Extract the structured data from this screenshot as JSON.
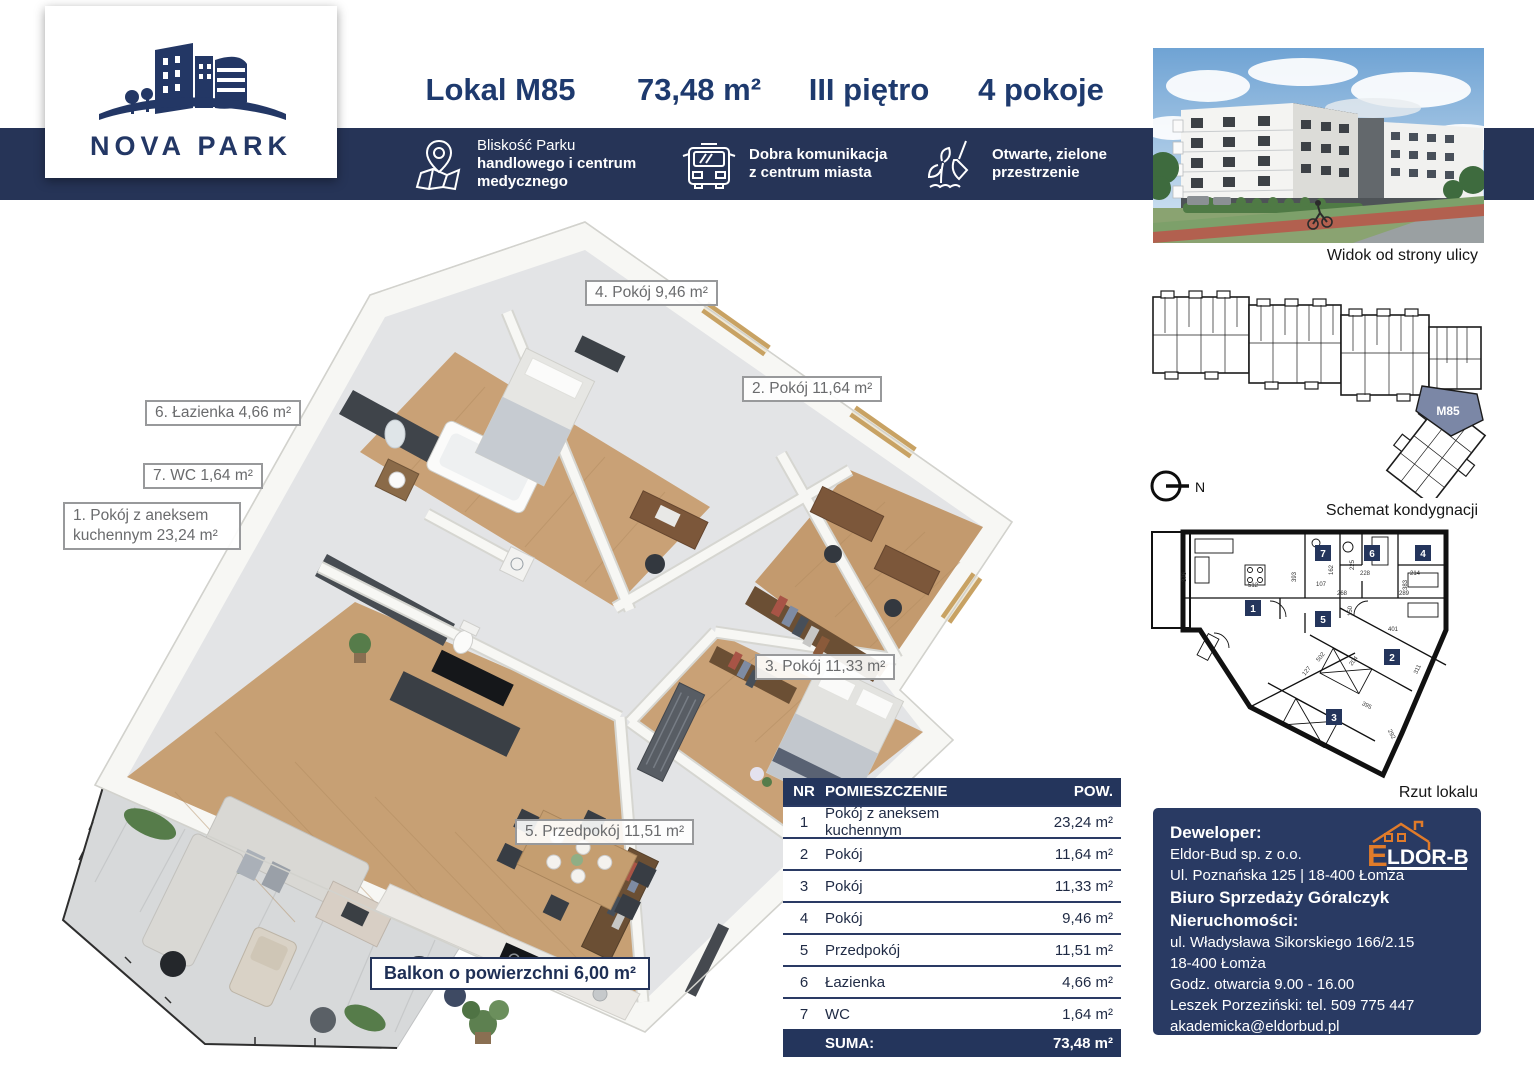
{
  "brand": {
    "name": "NOVA PARK"
  },
  "header": {
    "unit": "Lokal M85",
    "area": "73,48 m²",
    "floor": "III piętro",
    "rooms": "4 pokoje",
    "features": [
      {
        "icon": "map-pin-icon",
        "lines": [
          "Bliskość Parku",
          "handlowego i centrum",
          "medycznego"
        ]
      },
      {
        "icon": "bus-icon",
        "lines": [
          "Dobra komunikacja",
          "z centrum miasta"
        ]
      },
      {
        "icon": "plant-trowel-icon",
        "lines": [
          "Otwarte, zielone",
          "przestrzenie"
        ]
      }
    ]
  },
  "sidebar": {
    "photo_caption": "Widok od strony ulicy",
    "schematic_caption": "Schemat kondygnacji",
    "unit_plan_caption": "Rzut lokalu",
    "unit_label": "M85",
    "north_label": "N"
  },
  "floorplan": {
    "labels": {
      "r4": "4. Pokój 9,46 m²",
      "r2": "2. Pokój 11,64 m²",
      "r6": "6. Łazienka 4,66 m²",
      "r7": "7. WC 1,64 m²",
      "r1a": "1. Pokój z aneksem",
      "r1b": "kuchennym 23,24 m²",
      "r3": "3. Pokój 11,33 m²",
      "r5": "5. Przedpokój 11,51 m²",
      "balcony": "Balkon o powierzchni 6,00 m²"
    }
  },
  "plan": {
    "markers": [
      "1",
      "2",
      "3",
      "4",
      "5",
      "6",
      "7"
    ],
    "dims": [
      "376",
      "512",
      "393",
      "107",
      "162",
      "225",
      "228",
      "214",
      "383",
      "268",
      "150",
      "289",
      "401",
      "502",
      "204",
      "127",
      "311",
      "395",
      "292"
    ]
  },
  "table": {
    "headers": {
      "nr": "NR",
      "room": "POMIESZCZENIE",
      "area": "POW."
    },
    "rows": [
      {
        "nr": "1",
        "room": "Pokój z aneksem kuchennym",
        "area": "23,24 m²"
      },
      {
        "nr": "2",
        "room": "Pokój",
        "area": "11,64 m²"
      },
      {
        "nr": "3",
        "room": "Pokój",
        "area": "11,33 m²"
      },
      {
        "nr": "4",
        "room": "Pokój",
        "area": "9,46 m²"
      },
      {
        "nr": "5",
        "room": "Przedpokój",
        "area": "11,51 m²"
      },
      {
        "nr": "6",
        "room": "Łazienka",
        "area": "4,66 m²"
      },
      {
        "nr": "7",
        "room": "WC",
        "area": "1,64 m²"
      }
    ],
    "sum_label": "SUMA:",
    "sum_value": "73,48 m²"
  },
  "developer": {
    "heading": "Deweloper:",
    "company": "Eldor-Bud sp. z o.o.",
    "address": "Ul. Poznańska 125 | 18-400 Łomża",
    "office_heading": "Biuro Sprzedaży Góralczyk Nieruchomości:",
    "office_address1": "ul. Władysława Sikorskiego 166/2.15",
    "office_address2": "18-400 Łomża",
    "hours": "Godz. otwarcia 9.00 - 16.00",
    "contact": "Leszek Porzeziński: tel. 509 775 447",
    "email": "akademicka@eldorbud.pl",
    "website": "www.novapark2.pl",
    "logo_e": "E",
    "logo_rest": "LDOR-BUD"
  },
  "colors": {
    "navy_band": "#263457",
    "navy_panel": "#293a63",
    "title_navy": "#1e3a6e",
    "highlight_unit": "#7b87a6",
    "accent_orange": "#e07b2a",
    "wood": "#c9a176"
  }
}
